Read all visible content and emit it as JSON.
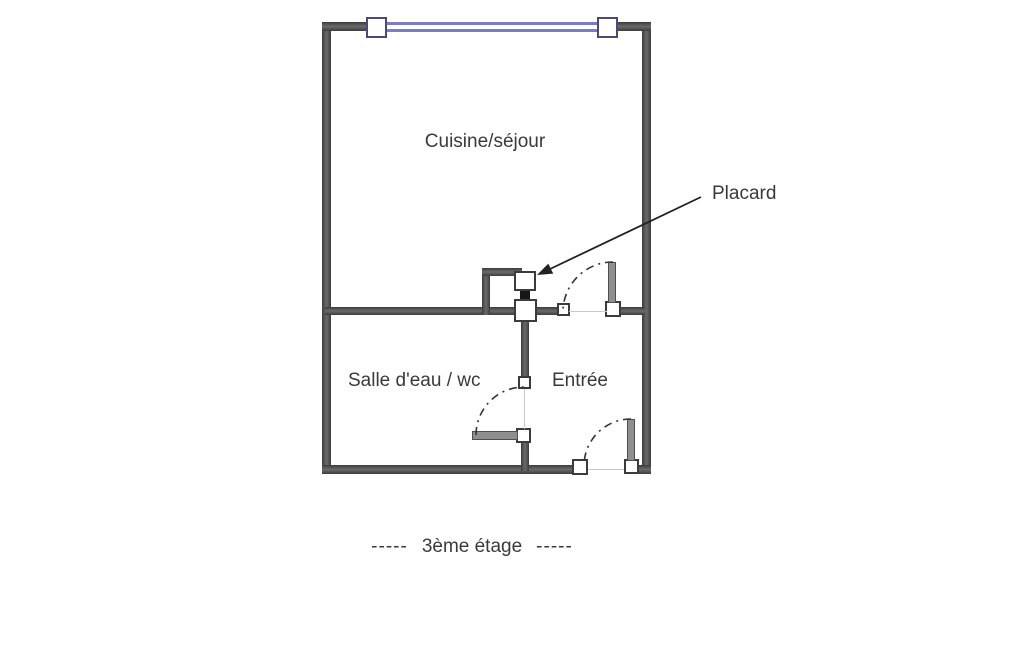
{
  "labels": {
    "room_main": "Cuisine/séjour",
    "closet": "Placard",
    "bathroom": "Salle d'eau / wc",
    "entry": "Entrée"
  },
  "caption": {
    "dashes_left": "-----",
    "text": "3ème étage",
    "dashes_right": "-----"
  },
  "colors": {
    "background": "#ffffff",
    "wall": "#4a4a4a",
    "window": "#7b7bc8",
    "window_post_border": "#4a4a78",
    "door_leaf": "#8f8f8f",
    "threshold_line": "#c9c9c9",
    "text": "#3a3a3a",
    "arrow": "#222222"
  }
}
